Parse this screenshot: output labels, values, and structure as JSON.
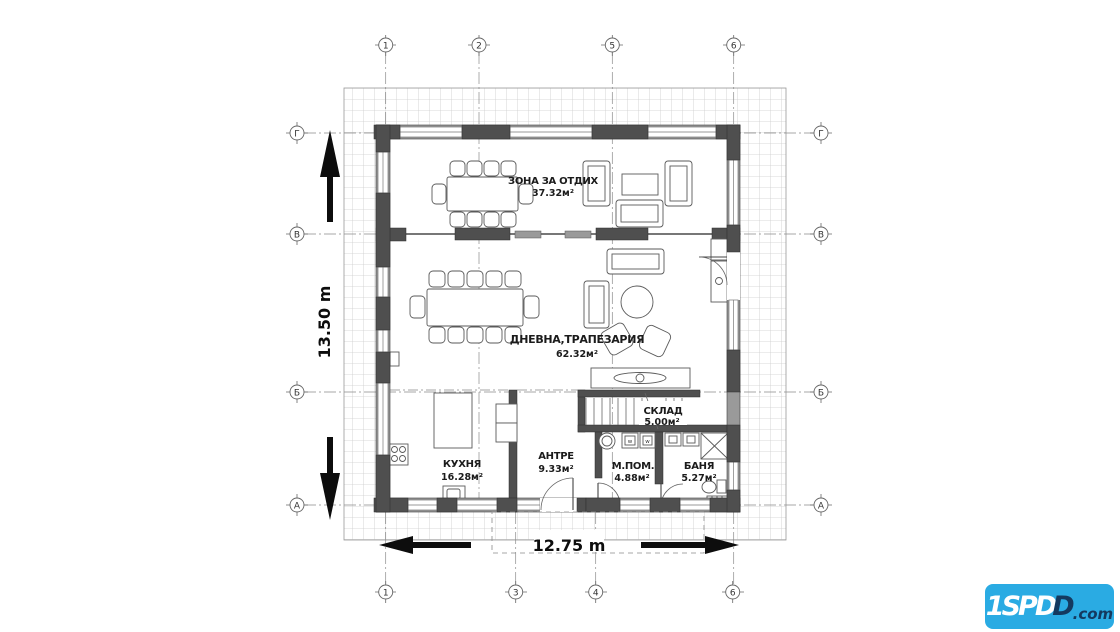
{
  "axes": {
    "top": [
      "1",
      "2",
      "5",
      "6"
    ],
    "bottom": [
      "1",
      "3",
      "4",
      "6"
    ],
    "left": [
      "Г",
      "В",
      "Б",
      "А"
    ],
    "right": [
      "Г",
      "В",
      "Б",
      "А"
    ]
  },
  "rooms": {
    "lounge": {
      "name": "ЗОНА ЗА ОТДИХ",
      "area": "37.32м²"
    },
    "living": {
      "name": "ДНЕВНА,ТРАПЕЗАРИЯ",
      "area": "62.32м²"
    },
    "kitchen": {
      "name": "КУХНЯ",
      "area": "16.28м²"
    },
    "hall": {
      "name": "АНТРЕ",
      "area": "9.33м²"
    },
    "storage": {
      "name": "СКЛАД",
      "area": "5.00м²"
    },
    "utility": {
      "name": "М.ПОМ.",
      "area": "4.88м²"
    },
    "bath": {
      "name": "БАНЯ",
      "area": "5.27м²"
    }
  },
  "dimensions": {
    "height": "13.50 m",
    "width": "12.75 m"
  },
  "appliances": {
    "washer1": "w",
    "washer2": "w"
  },
  "logo": {
    "light": "1SPD",
    "dark": "D",
    "suffix": ".com"
  },
  "colors": {
    "logo_bg": "#2aabe3",
    "logo_dark": "#14395f",
    "wall": "#9a9a9a",
    "column": "#4f4f4f",
    "grid": "#cccccc"
  }
}
